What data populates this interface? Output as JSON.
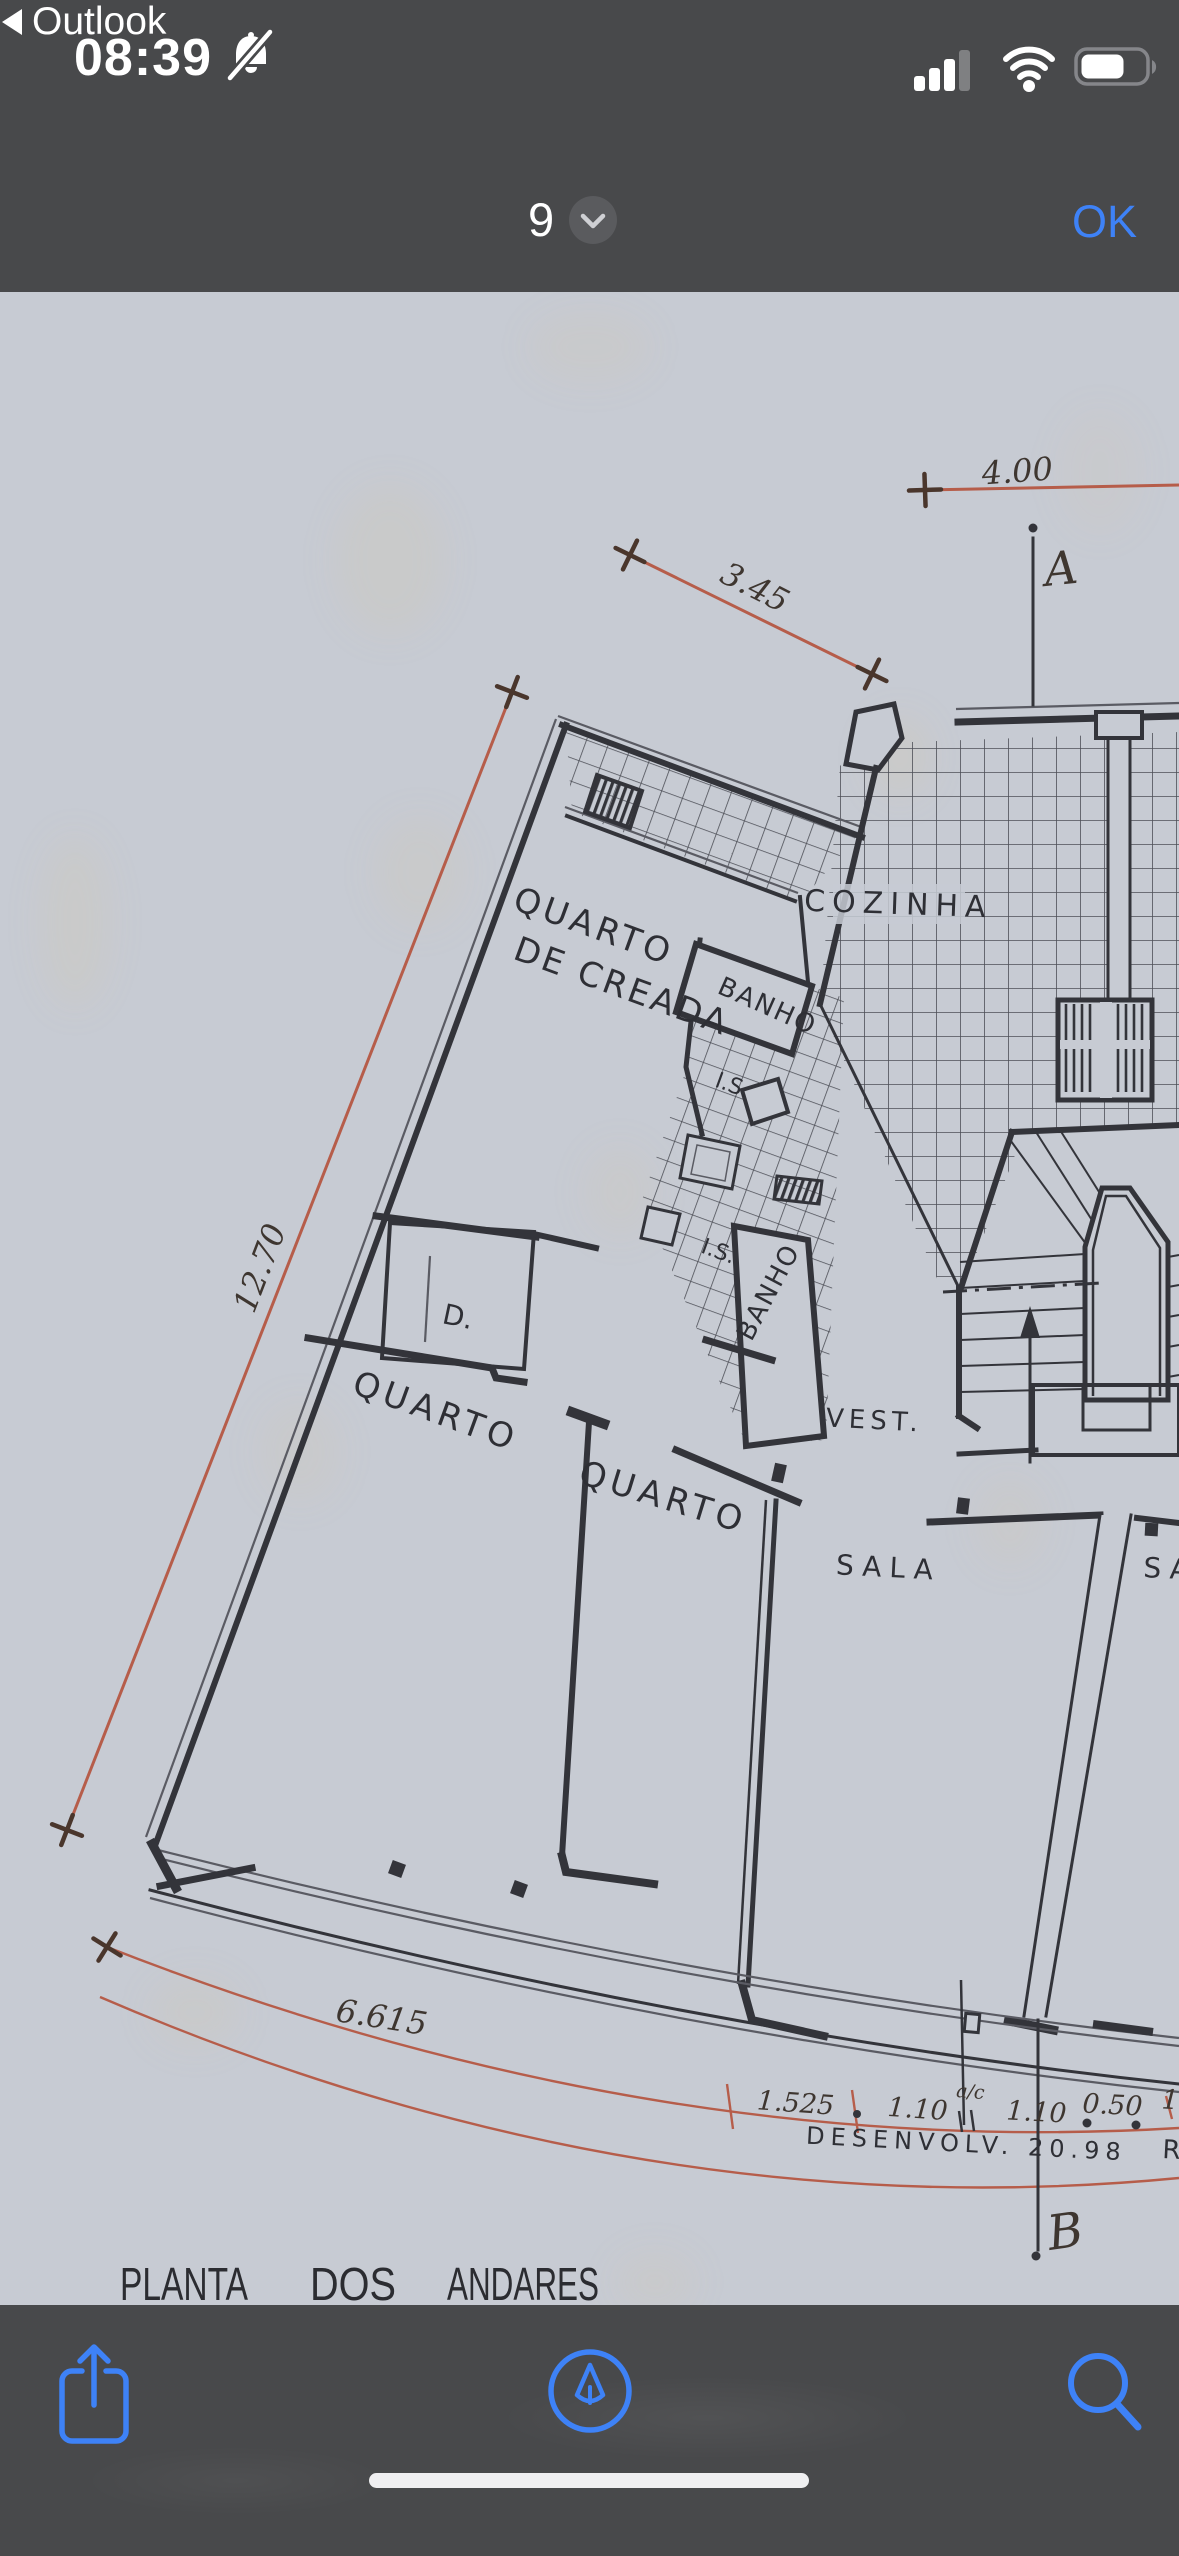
{
  "colors": {
    "accent_blue": "#3E82F7",
    "bar_background": "#48494B",
    "paper": "#C7CBD3",
    "ink": "#33343A",
    "dimension_red": "#B65D4A"
  },
  "status_bar": {
    "time": "08:39",
    "back_label": "Outlook"
  },
  "nav_bar": {
    "page_number": "9",
    "ok_label": "OK"
  },
  "icons": [
    "bell-slash-icon",
    "back-chevron-icon",
    "cell-signal-icon",
    "wifi-icon",
    "battery-icon",
    "chevron-down-icon",
    "share-icon",
    "markup-icon",
    "search-icon"
  ],
  "floorplan": {
    "title_words": [
      "PLANTA",
      "DOS",
      "ANDARES"
    ],
    "rooms": {
      "maid_room_line1": "QUARTO",
      "maid_room_line2": "DE CREADA",
      "bath1": "BANHO",
      "bath2": "BANHO",
      "kitchen": "COZINHA",
      "wc1": "I.S.",
      "wc2": "I.S.",
      "vestibule": "VEST.",
      "closet": "D.",
      "bedroom1": "QUARTO",
      "bedroom2": "QUARTO",
      "living1": "SALA",
      "living2": "SALA"
    },
    "dimensions": {
      "top": "4.00",
      "upper_diag": "3.45",
      "left_diag": "12.70",
      "bottom_arc": "6.615",
      "arc_seg1": "1.525",
      "arc_seg2": "1.10",
      "arc_note": "a/c",
      "arc_seg3": "1.10",
      "arc_seg4": "0.50",
      "arc_partial": "1.",
      "development": "DESENVOLV. 20.98",
      "development_partial": "R"
    },
    "section_markers": {
      "a": "A",
      "b": "B"
    }
  }
}
